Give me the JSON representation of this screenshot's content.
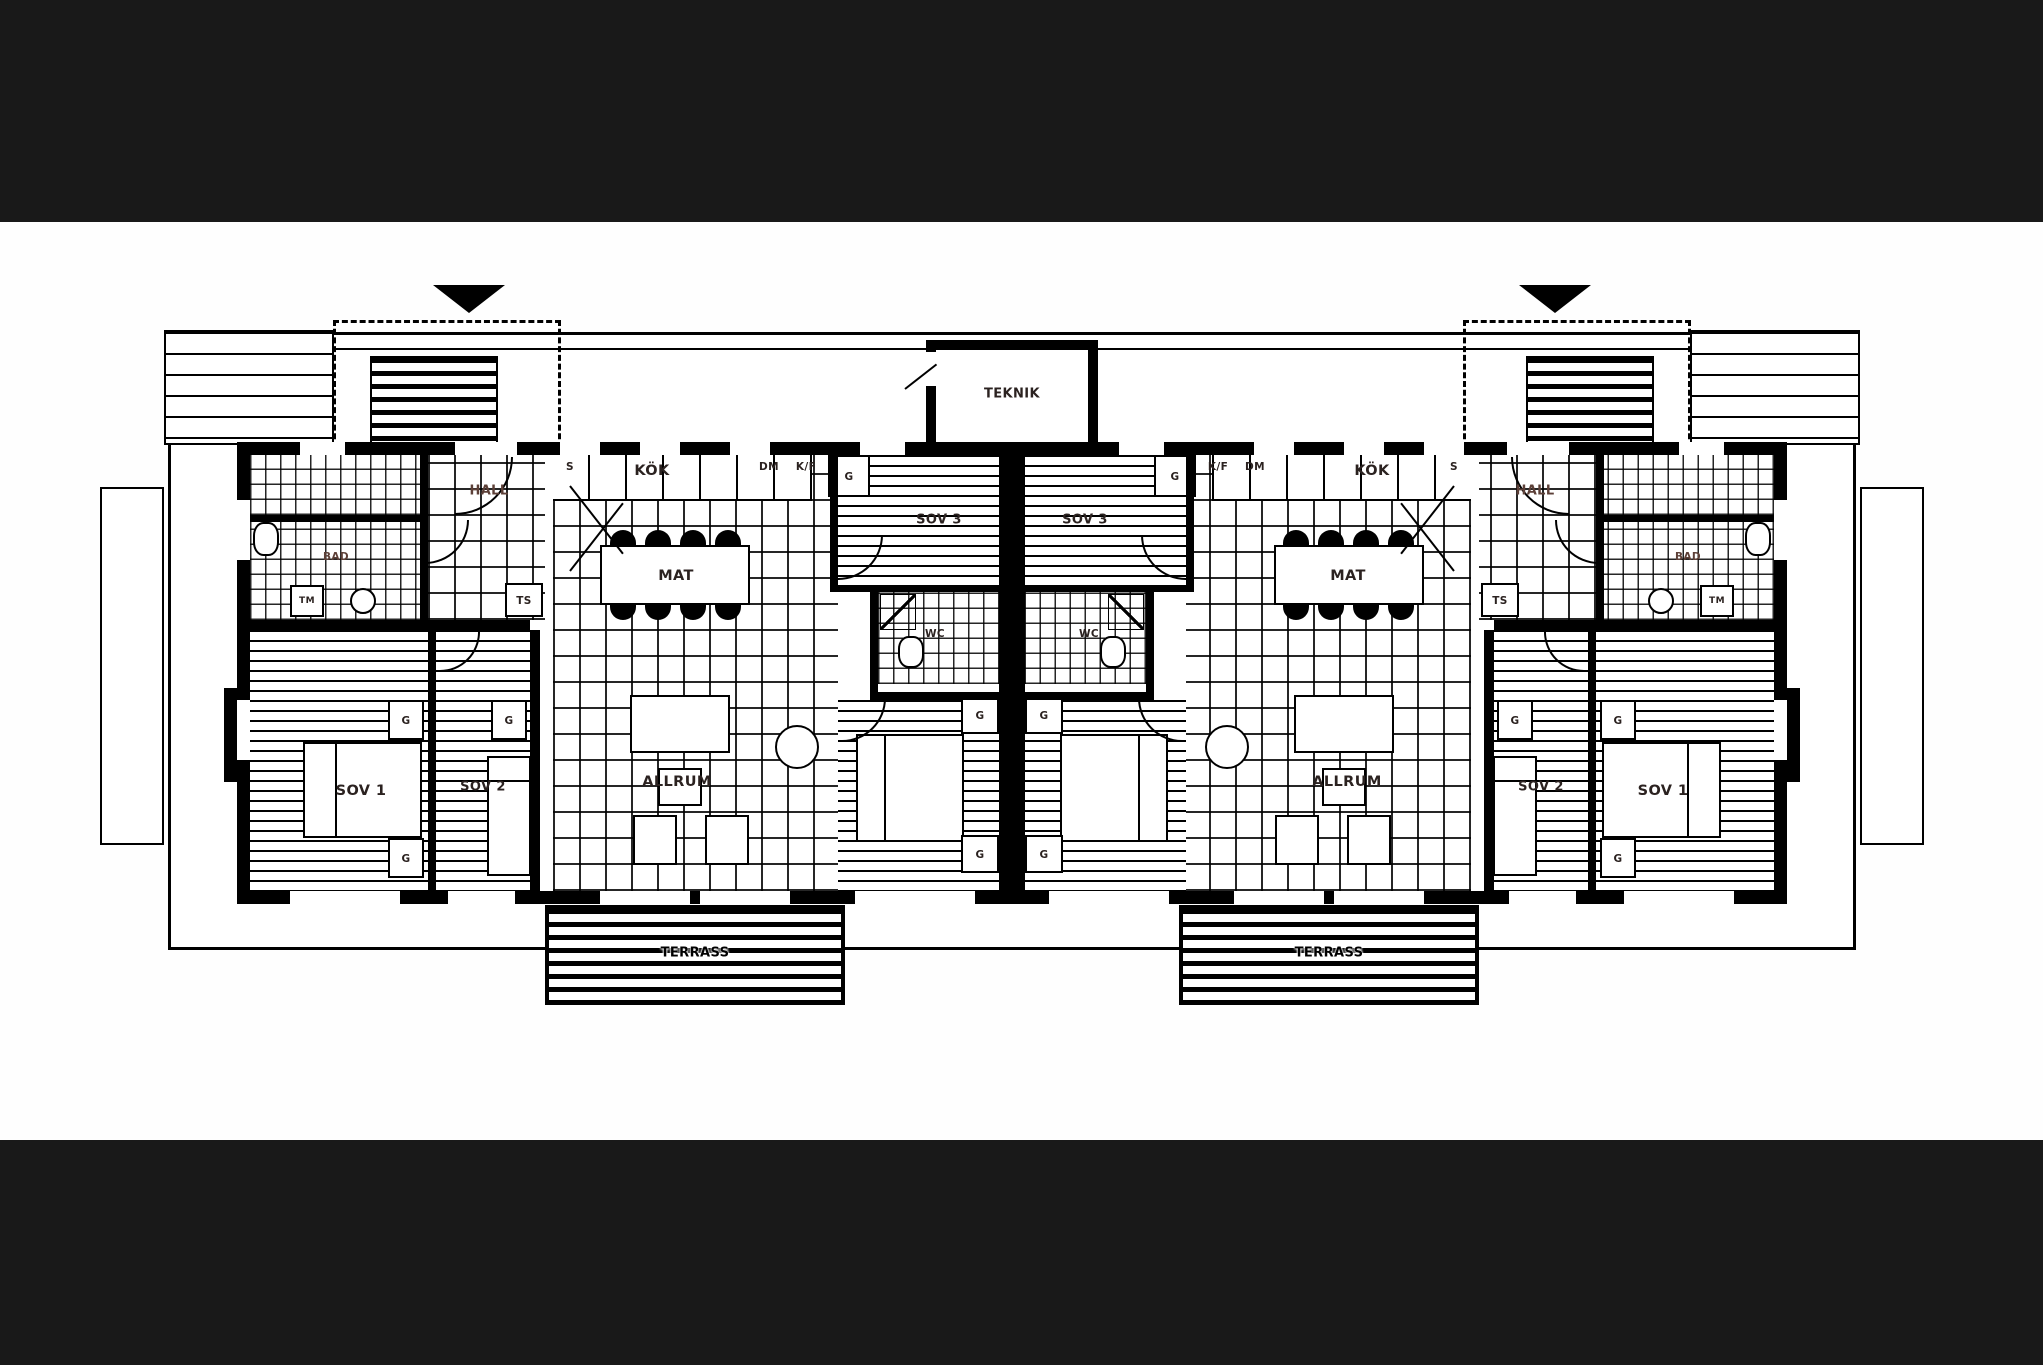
{
  "meta": {
    "bar_color": "#191919",
    "paper_color": "#fefefe",
    "ink_color": "#000000",
    "label_color": "#2b2220"
  },
  "plan": {
    "teknik_label": "TEKNIK",
    "unit_left": {
      "kok": "KÖK",
      "s": "S",
      "dm": "DM",
      "kf": "K/F",
      "mat": "MAT",
      "hall": "HALL",
      "ts": "TS",
      "bad": "BAD",
      "tm": "TM",
      "allrum": "ALLRUM",
      "wc": "WC",
      "sov1": "SOV 1",
      "sov2": "SOV 2",
      "sov3": "SOV 3",
      "sov4": "SOV 4",
      "g": "G",
      "terrace": "TERRASS"
    },
    "unit_right": {
      "kok": "KÖK",
      "s": "S",
      "dm": "DM",
      "kf": "K/F",
      "mat": "MAT",
      "hall": "HALL",
      "ts": "TS",
      "bad": "BAD",
      "tm": "TM",
      "allrum": "ALLRUM",
      "wc": "WC",
      "sov1": "SOV 1",
      "sov2": "SOV 2",
      "sov3": "SOV 3",
      "sov4": "SOV 4",
      "g": "G",
      "terrace": "TERRASS"
    }
  }
}
